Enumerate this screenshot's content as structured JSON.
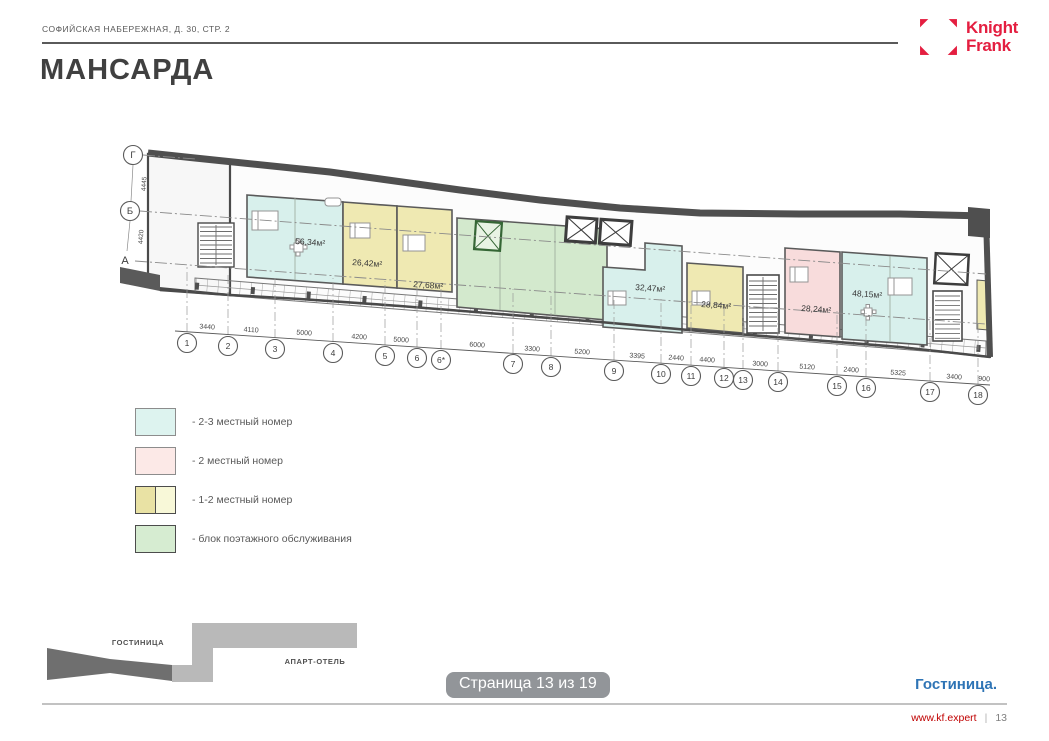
{
  "header": {
    "address": "СОФИЙСКАЯ НАБЕРЕЖНАЯ, Д. 30, СТР. 2"
  },
  "logo": {
    "line1": "Knight",
    "line2": "Frank"
  },
  "page_title": "МАНСАРДА",
  "plan": {
    "grid_letters": [
      "Г",
      "Б",
      "А"
    ],
    "left_dims": [
      "4445",
      "4420"
    ],
    "area_labels": [
      "56,34м²",
      "26,42м²",
      "27,68м²",
      "32,47м²",
      "28,84м²",
      "28,24м²",
      "48,15м²"
    ],
    "column_labels": [
      "1",
      "2",
      "3",
      "4",
      "5",
      "6",
      "6*",
      "7",
      "8",
      "9",
      "10",
      "11",
      "12",
      "13",
      "14",
      "15",
      "16",
      "17",
      "18"
    ],
    "dim_labels": [
      "3440",
      "4110",
      "5000",
      "4200",
      "5000",
      "6000",
      "3300",
      "5200",
      "3395",
      "2440",
      "4400",
      "3000",
      "5120",
      "2400",
      "5325",
      "3400",
      "900"
    ]
  },
  "legend": {
    "items": [
      {
        "label": "- 2-3 местный номер",
        "swatch": [
          "#ddf3ef"
        ]
      },
      {
        "label": "- 2 местный номер",
        "swatch": [
          "#fce9e7"
        ]
      },
      {
        "label": "- 1-2 местный номер",
        "swatch": [
          "#e9e2a4",
          "#f8f8d8"
        ]
      },
      {
        "label": "- блок поэтажного обслуживания",
        "swatch": [
          "#d6ecd1"
        ]
      }
    ]
  },
  "minimap": {
    "hotel_label": "ГОСТИНИЦА",
    "apart_label": "АПАРТ-ОТЕЛЬ"
  },
  "page_badge": "Страница 13 из 19",
  "section_label": "Гостиница.",
  "footer": {
    "site": "www.kf.expert",
    "separator": "|",
    "page_number": "13"
  },
  "colors": {
    "brand_red": "#e41e40",
    "link_red": "#c00000",
    "section_blue": "#2e74b5",
    "room_2_3_bed": "#d8f0ec",
    "room_2_bed": "#f8dcdc",
    "room_1_2_bed": "#efe9b2",
    "room_1_2_bed_light": "#f8f8d8",
    "service_block": "#d3e9cd"
  }
}
